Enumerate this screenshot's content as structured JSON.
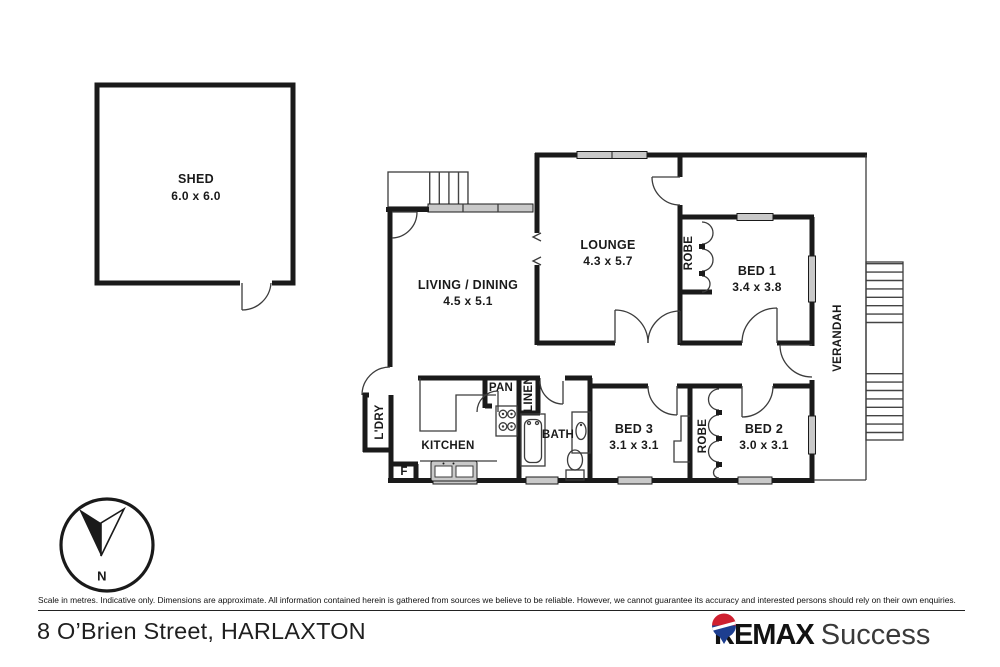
{
  "colors": {
    "wall": "#1a1a1a",
    "window_fill": "#c9c9c9",
    "balloon_red": "#cf2030",
    "balloon_blue": "#1d3e90"
  },
  "labels": {
    "shed_name": "SHED",
    "shed_dims": "6.0 x 6.0",
    "living_name": "LIVING / DINING",
    "living_dims": "4.5 x 5.1",
    "lounge_name": "LOUNGE",
    "lounge_dims": "4.3 x 5.7",
    "bed1_name": "BED 1",
    "bed1_dims": "3.4 x 3.8",
    "bed2_name": "BED 2",
    "bed2_dims": "3.0 x 3.1",
    "bed3_name": "BED 3",
    "bed3_dims": "3.1 x 3.1",
    "kitchen": "KITCHEN",
    "bath": "BATH",
    "pan": "PAN",
    "linen": "LINEN",
    "ldry": "L'DRY",
    "robe_bed1": "ROBE",
    "robe_bed2": "ROBE",
    "verandah": "VERANDAH",
    "fridge": "F",
    "north": "N"
  },
  "footer": {
    "disclaimer": "Scale in metres. Indicative only. Dimensions are approximate. All information contained herein is gathered from sources we believe to be reliable. However, we cannot guarantee its accuracy and interested persons should rely on their own enquiries.",
    "address": "8 O’Brien Street, HARLAXTON"
  },
  "brand": {
    "primary": "REMAX",
    "secondary": "Success"
  }
}
